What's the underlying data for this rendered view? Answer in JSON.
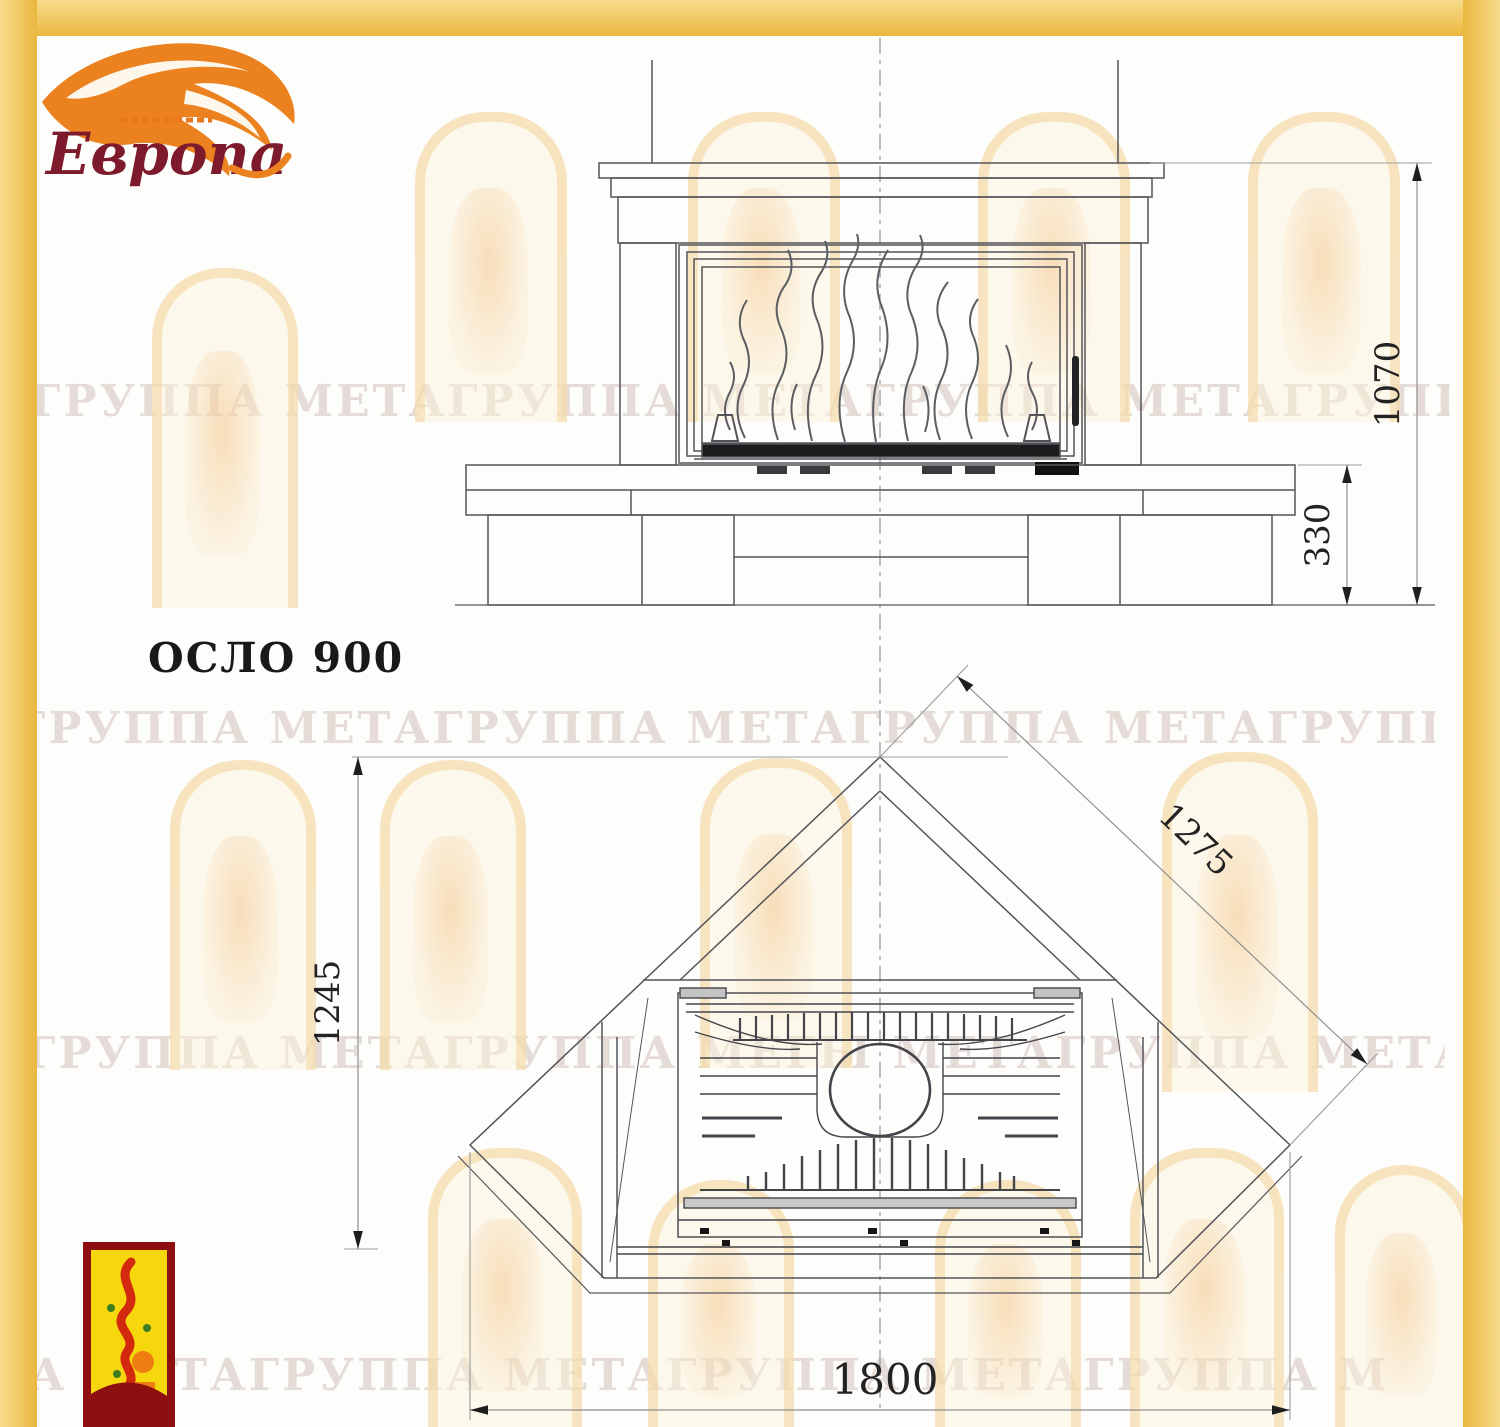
{
  "logo": {
    "brand": "Европа"
  },
  "product": {
    "label": "ОСЛО 900"
  },
  "dimensions": {
    "front_height_total": "1070",
    "front_height_hearth": "330",
    "plan_depth": "1245",
    "plan_side": "1275",
    "plan_width": "1800"
  },
  "watermark": {
    "row1": "ГРУППА МЕТАГРУППА МЕТАГРУППА МЕТАГРУППА МЕГА",
    "row2": "ГРУППА МЕТАГРУППА МЕТАГРУППА МЕТАГРУППА МЕТА",
    "row3": "ГРУППА МЕТАГРУППА МЕГЫ МЕТАГРУППА МЕТАГРУППА",
    "row4": "ША МЕТАГРУППА МЕТАГРУППА МЕТАГРУППА МЕТАГРУП"
  }
}
